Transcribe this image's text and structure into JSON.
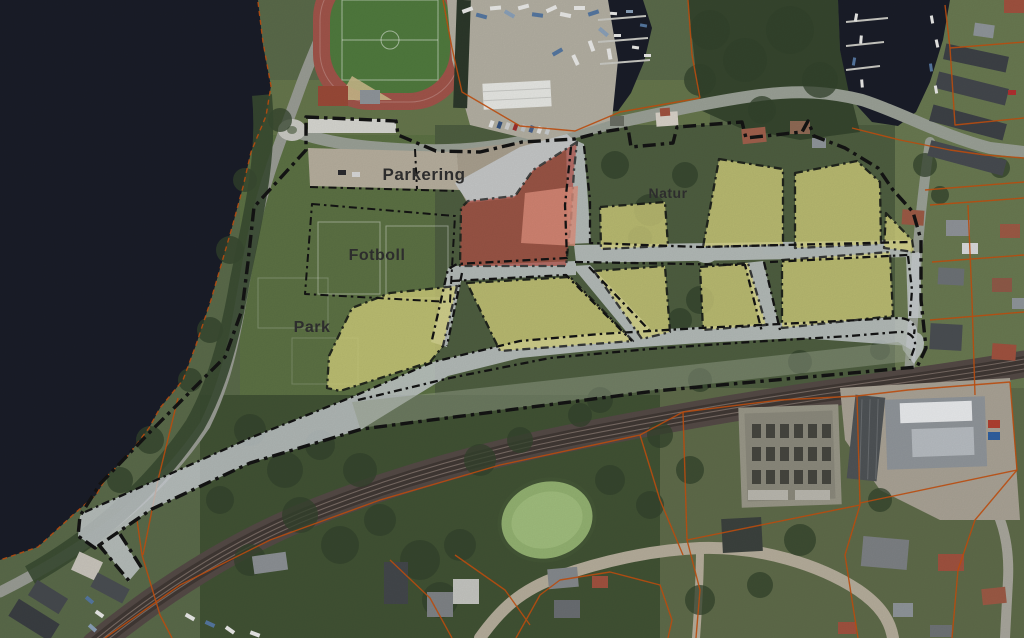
{
  "map": {
    "labels": {
      "parkering": "Parkering",
      "fotboll": "Fotboll",
      "park": "Park",
      "natur": "Natur"
    },
    "colors": {
      "zone_center_red": "#b65148",
      "zone_center_red_light": "#dd8f7c",
      "zone_residential_yellow": "#d6d37e",
      "road_overlay": "#cbd0d4",
      "green_strip": "#96a089",
      "boundary_black": "#141414",
      "cadastral_orange": "#c2500f",
      "water_dark": "#1a1d28",
      "label_text": "#303030"
    }
  }
}
